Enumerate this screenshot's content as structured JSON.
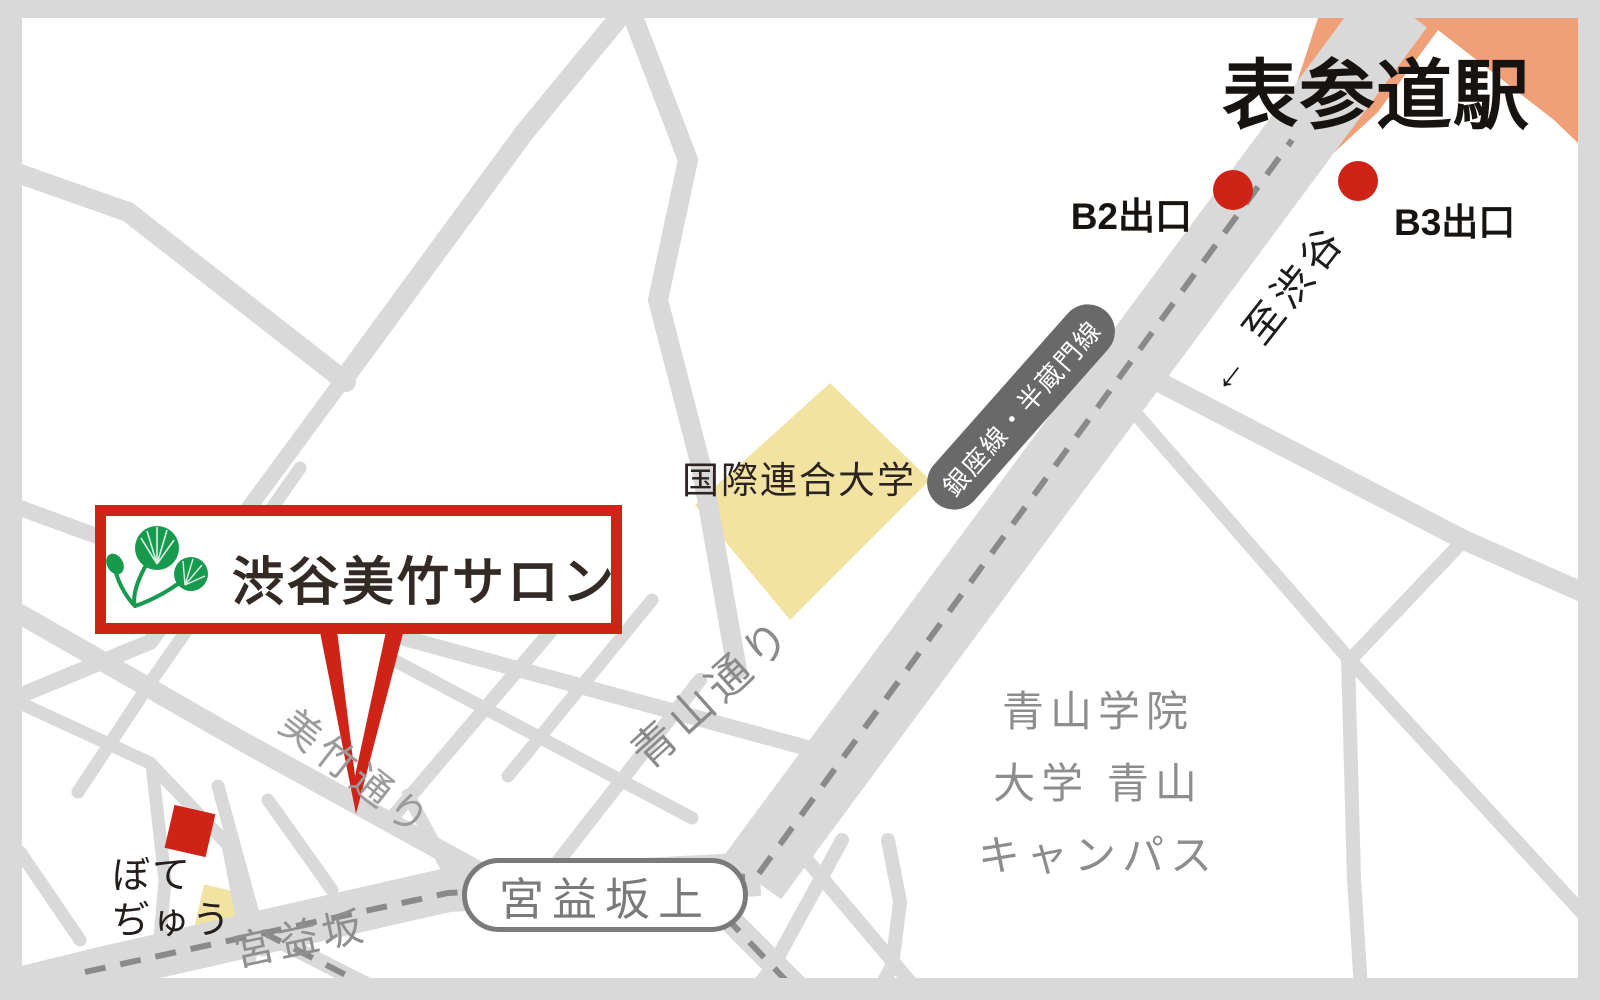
{
  "theme": {
    "accent_red": "#cf2318",
    "station_orange": "#efa078",
    "building_yellow": "#f3e3a2",
    "road_gray": "#d9d9d9",
    "route_dash_gray": "#8a8a8a",
    "line_badge_gray": "#696969",
    "label_gray": "#8f8f8f",
    "text_dark": "#241f1c"
  },
  "station": {
    "name": "表参道駅",
    "exit_b2_label": "B2出口",
    "exit_b3_label": "B3出口",
    "direction_note": "← 至渋谷"
  },
  "transit": {
    "line_badge": "銀座線・半蔵門線"
  },
  "roads": {
    "aoyama": "青山通り",
    "mitake": "美竹通り",
    "miyamasuzaka": "宮益坂",
    "miyamasuzaka_ue": "宮益坂上"
  },
  "places": {
    "un_university": "国際連合大学",
    "aoyama_gakuin_lines": [
      "青山学院",
      "大学 青山",
      "キャンパス"
    ],
    "botejyu_lines": [
      "ぼて",
      "ぢゅう"
    ]
  },
  "salon": {
    "name": "渋谷美竹サロン",
    "logo": "futaba-aoi-leaf-icon"
  }
}
